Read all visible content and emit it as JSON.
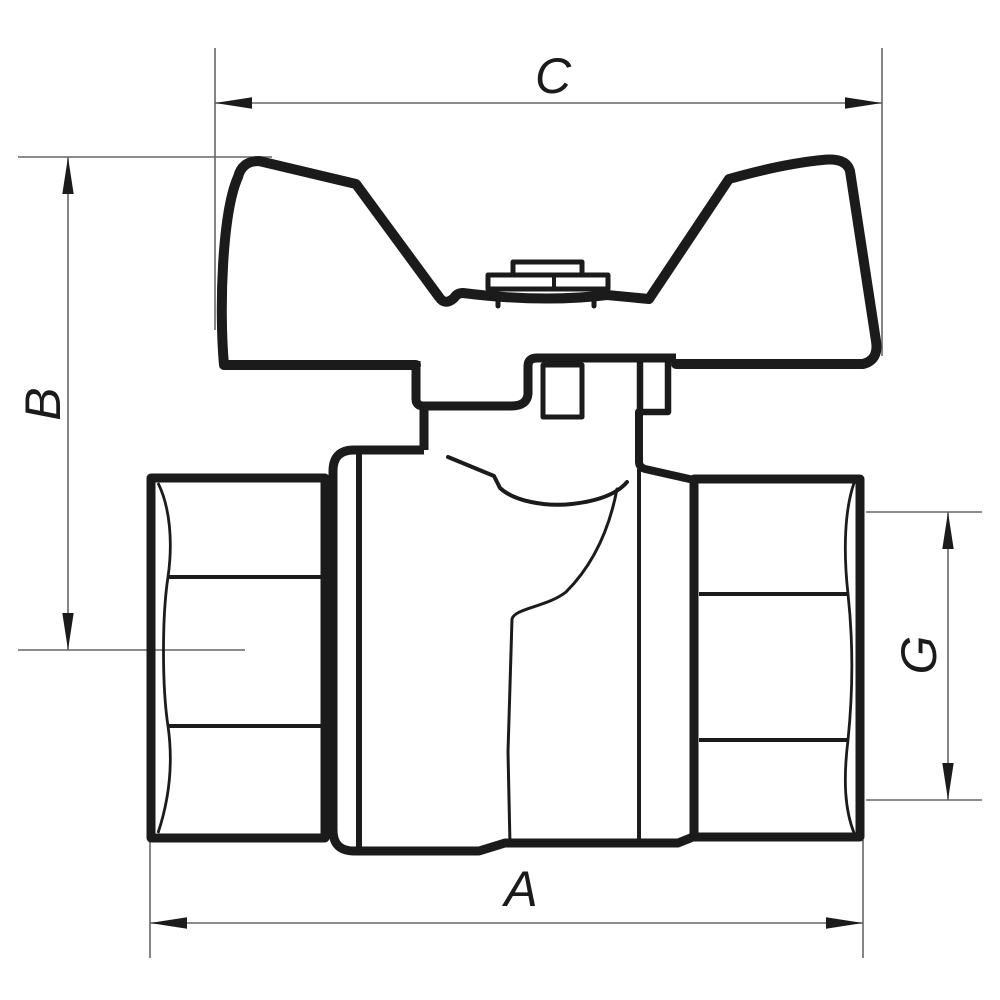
{
  "page": {
    "background": "#ffffff",
    "subject": "Ball valve with butterfly T-handle, side elevation technical drawing"
  },
  "drawing": {
    "stroke_color": "#1b1b1b",
    "dimension_line_color": "#666666",
    "dimensions": [
      {
        "id": "C",
        "label": "C",
        "orientation": "horizontal",
        "position": "top",
        "measures": "overall handle width"
      },
      {
        "id": "B",
        "label": "B",
        "orientation": "vertical",
        "position": "left",
        "measures": "height from pipe axis to handle top"
      },
      {
        "id": "A",
        "label": "A",
        "orientation": "horizontal",
        "position": "bottom",
        "measures": "overall body length"
      },
      {
        "id": "G",
        "label": "G",
        "orientation": "vertical",
        "position": "right",
        "measures": "thread bore size"
      }
    ]
  }
}
